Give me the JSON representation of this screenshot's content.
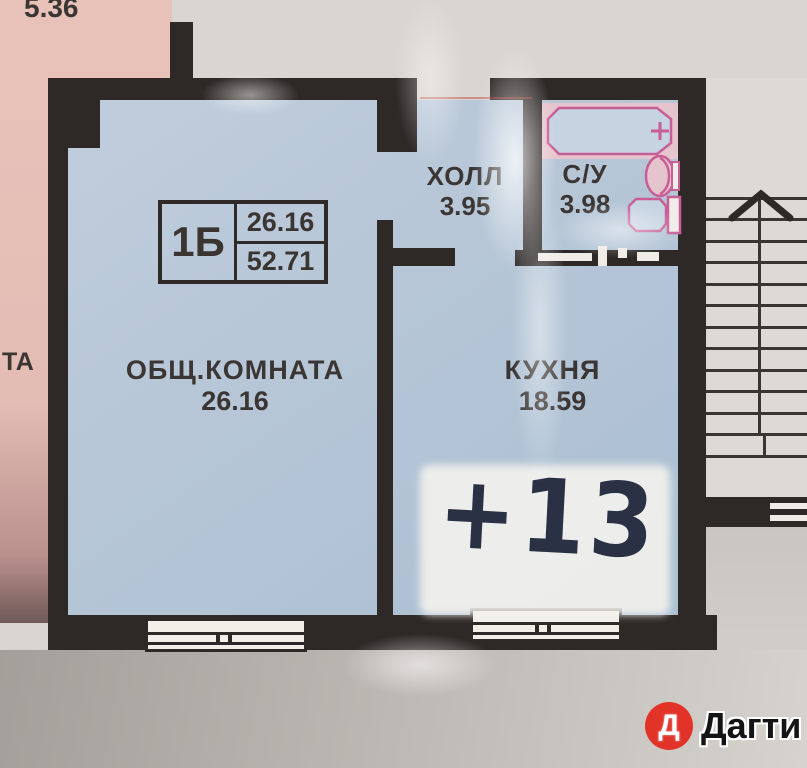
{
  "neighbor": {
    "area_top_left": "5.36",
    "partial_room_text": "ТА"
  },
  "unit_card": {
    "unit_label": "1Б",
    "living_area": "26.16",
    "total_area": "52.71"
  },
  "rooms": {
    "living": {
      "name": "ОБЩ.КОМНАТА",
      "area": "26.16"
    },
    "hall": {
      "name": "ХОЛЛ",
      "area": "3.95"
    },
    "bathroom": {
      "name": "С/У",
      "area": "3.98"
    },
    "kitchen": {
      "name": "КУХНЯ",
      "area": "18.59"
    }
  },
  "annotation": {
    "handwritten_text": "+13"
  },
  "brand": {
    "logo_letter": "Д",
    "name": "Дагти",
    "logo_color": "#e23329"
  },
  "colors": {
    "wall": "#2e2927",
    "room_fill": "#b6c6d7",
    "neighbor_pink": "#e8c2b9",
    "fixture_pink": "#c75f96",
    "background_gray": "#d8d4d0"
  }
}
